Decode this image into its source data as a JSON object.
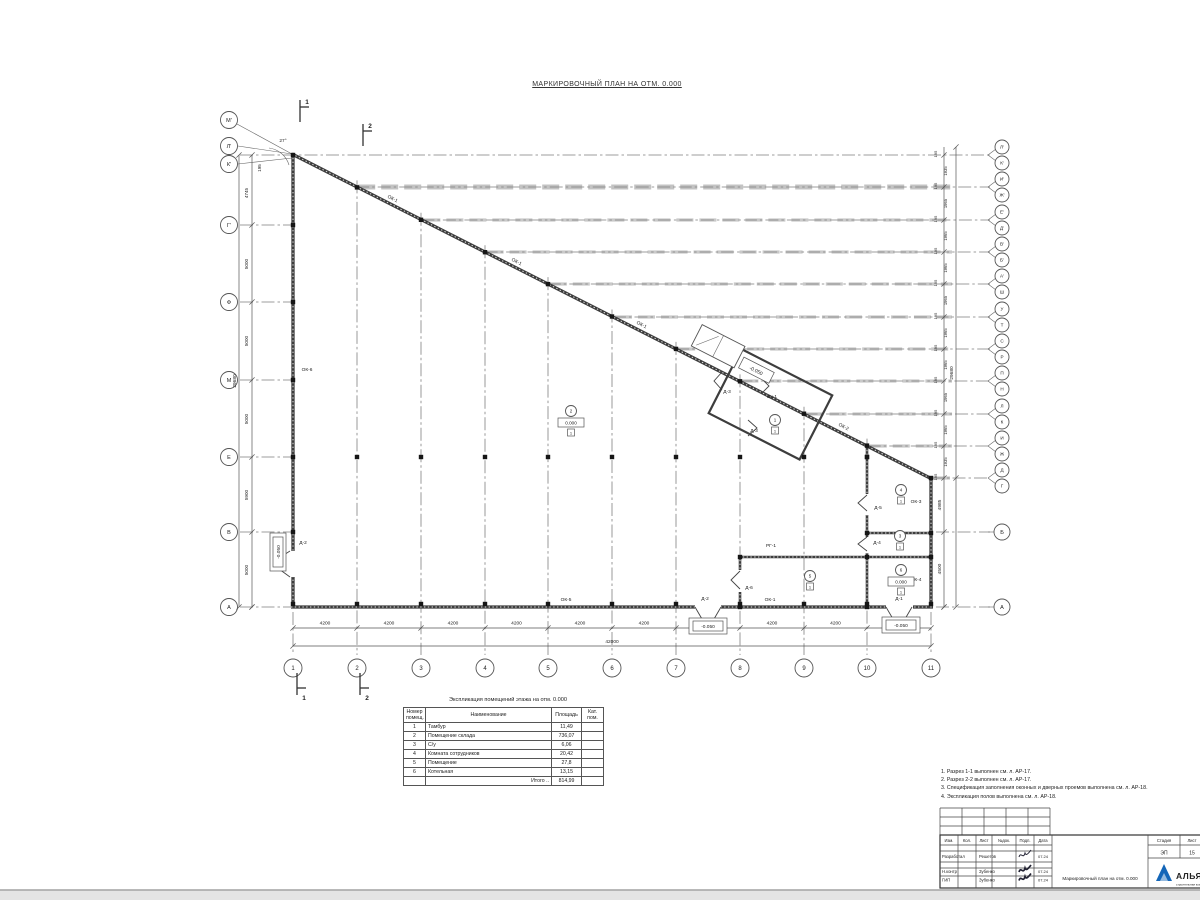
{
  "title": "МАРКИРОВОЧНЫЙ ПЛАН НА ОТМ. 0.000",
  "colors": {
    "accent_blue": "#1466b8",
    "band_gray": "#c9c9c9"
  },
  "plan": {
    "diag": {
      "x1": 293,
      "y1": 155,
      "x2": 931,
      "y2": 478,
      "slope": 0.5063
    },
    "walls": {
      "ext": [
        [
          293,
          154,
          293,
          608
        ],
        [
          291,
          607,
          933,
          607
        ],
        [
          931,
          477,
          931,
          608
        ],
        [
          292,
          154,
          932,
          479
        ]
      ],
      "int": [
        [
          867,
          446,
          867,
          607
        ],
        [
          740,
          556,
          740,
          607
        ],
        [
          739,
          557,
          932,
          557
        ],
        [
          866,
          533,
          932,
          533
        ]
      ],
      "gaps": [
        [
          695,
          602,
          26,
          9
        ],
        [
          886,
          602,
          27,
          9
        ],
        [
          288,
          551,
          9,
          26
        ],
        [
          863,
          494,
          8,
          21
        ],
        [
          863,
          537,
          8,
          16
        ],
        [
          736,
          570,
          8,
          22
        ]
      ],
      "doors": [
        "M695,607 L702,619 L714,619 L721,607",
        "M886,607 L893,619 L905,619 L912,607",
        "M290,551 L279,558 L279,569 L290,577",
        "M867,495 l-9,8 l9,8",
        "M867,537 l-9,7 l9,7",
        "M740,571 l-9,9 l9,9",
        "M722,372 l-8,9 l8,9",
        "M748,420 l9,8 l-9,8",
        "M762,379 l7,7 l-7,7"
      ]
    },
    "tambour": {
      "cx": 766,
      "cy": 402,
      "rot": 27,
      "main": [
        -46,
        -36,
        102,
        72
      ],
      "porch": [
        -92,
        -40,
        48,
        24
      ],
      "ebox": [
        -40,
        -30,
        34,
        12
      ],
      "etext": "-0.050"
    },
    "bottom_axes": [
      {
        "n": "1",
        "x": 293
      },
      {
        "n": "2",
        "x": 357
      },
      {
        "n": "3",
        "x": 421
      },
      {
        "n": "4",
        "x": 485
      },
      {
        "n": "5",
        "x": 548
      },
      {
        "n": "6",
        "x": 612
      },
      {
        "n": "7",
        "x": 676
      },
      {
        "n": "8",
        "x": 740
      },
      {
        "n": "9",
        "x": 804
      },
      {
        "n": "10",
        "x": 867
      },
      {
        "n": "11",
        "x": 931
      }
    ],
    "bottom_seg_dim": "4200",
    "bottom_total": "42000",
    "left_axes": [
      {
        "n": "М'",
        "cy": 120
      },
      {
        "n": "Л'",
        "cy": 146
      },
      {
        "n": "К'",
        "cy": 164
      },
      {
        "n": "Г'",
        "cy": 225,
        "row": 225
      },
      {
        "n": "Ф",
        "cy": 302,
        "row": 302
      },
      {
        "n": "М",
        "cy": 380,
        "row": 380
      },
      {
        "n": "Е",
        "cy": 457,
        "row": 457
      },
      {
        "n": "В",
        "cy": 532,
        "row": 532
      },
      {
        "n": "А",
        "cy": 607,
        "row": 607
      }
    ],
    "left_dim_labels": [
      {
        "t": "195",
        "y": 168,
        "x": 261
      },
      {
        "t": "4745",
        "y": 193
      },
      {
        "t": "5000",
        "y": 264
      },
      {
        "t": "5000",
        "y": 341
      },
      {
        "t": "5000",
        "y": 419
      },
      {
        "t": "5900",
        "y": 495
      },
      {
        "t": "5000",
        "y": 570
      }
    ],
    "left_total": "29680",
    "pair_rows": [
      {
        "y": 155,
        "a": "Л'",
        "b": "К'"
      },
      {
        "y": 187,
        "a": "И'",
        "b": "Ж'"
      },
      {
        "y": 220,
        "a": "Е'",
        "b": "Д'"
      },
      {
        "y": 252,
        "a": "В'",
        "b": "Б'"
      },
      {
        "y": 284,
        "a": "А'",
        "b": "Ш"
      },
      {
        "y": 317,
        "a": "У",
        "b": "Т"
      },
      {
        "y": 349,
        "a": "С",
        "b": "Р"
      },
      {
        "y": 381,
        "a": "П",
        "b": "Н"
      },
      {
        "y": 414,
        "a": "Л",
        "b": "К"
      },
      {
        "y": 446,
        "a": "И",
        "b": "Ж"
      },
      {
        "y": 478,
        "a": "Д",
        "b": "Г"
      }
    ],
    "right_pair_dim": "195",
    "right_gap_dims": [
      "1935",
      "1965",
      "1965",
      "1965",
      "1965",
      "1965",
      "1965",
      "1965",
      "1965",
      "1935"
    ],
    "right_total": "29680",
    "right_low_axes": [
      {
        "n": "Б",
        "y": 532
      },
      {
        "n": "А",
        "y": 607
      }
    ],
    "right_low_dims": [
      {
        "t": "4985",
        "y": 505
      },
      {
        "t": "4500",
        "y": 569
      }
    ],
    "mark_labels": [
      {
        "t": "ОК-1",
        "x": 392,
        "y": 200,
        "r": 27
      },
      {
        "t": "ОК-1",
        "x": 516,
        "y": 263,
        "r": 27
      },
      {
        "t": "ОК-1",
        "x": 641,
        "y": 326,
        "r": 27
      },
      {
        "t": "ОК-2",
        "x": 843,
        "y": 428,
        "r": 27
      },
      {
        "t": "ОК-3",
        "x": 916,
        "y": 503
      },
      {
        "t": "ОК-4",
        "x": 916,
        "y": 581
      },
      {
        "t": "ОК-5",
        "x": 566,
        "y": 601
      },
      {
        "t": "ОК-1",
        "x": 770,
        "y": 601
      },
      {
        "t": "ОК-6",
        "x": 307,
        "y": 371
      },
      {
        "t": "РГ-1",
        "x": 771,
        "y": 547
      },
      {
        "t": "Д-2",
        "x": 303,
        "y": 544
      },
      {
        "t": "Д-2",
        "x": 705,
        "y": 600
      },
      {
        "t": "Д-1",
        "x": 899,
        "y": 600
      },
      {
        "t": "Д-6",
        "x": 749,
        "y": 589
      },
      {
        "t": "Д-5",
        "x": 878,
        "y": 509
      },
      {
        "t": "Д-4",
        "x": 877,
        "y": 544
      },
      {
        "t": "Д-3",
        "x": 727,
        "y": 393
      },
      {
        "t": "Д-3",
        "x": 754,
        "y": 432
      },
      {
        "t": "Вн-1",
        "x": 772,
        "y": 398
      }
    ],
    "rooms": [
      {
        "n": "1",
        "x": 775,
        "y": 420,
        "f": "1"
      },
      {
        "n": "2",
        "x": 571,
        "y": 411,
        "e": "0.000",
        "f": "1"
      },
      {
        "n": "3",
        "x": 900,
        "y": 536,
        "f": "1"
      },
      {
        "n": "4",
        "x": 901,
        "y": 490,
        "f": "1"
      },
      {
        "n": "5",
        "x": 810,
        "y": 576,
        "f": "1"
      },
      {
        "n": "6",
        "x": 901,
        "y": 570,
        "e": "0.000",
        "f": "1"
      }
    ],
    "elevations": [
      {
        "t": "-0.050",
        "x": 278,
        "y": 552,
        "r": -90
      },
      {
        "t": "-0.050",
        "x": 708,
        "y": 626,
        "r": 0
      },
      {
        "t": "-0.050",
        "x": 901,
        "y": 625,
        "r": 0
      }
    ],
    "sections": [
      {
        "n": "1",
        "x": 300,
        "y": 100,
        "d": 1
      },
      {
        "n": "2",
        "x": 363,
        "y": 124,
        "d": 1
      },
      {
        "n": "1",
        "x": 297,
        "y": 673,
        "d": -1
      },
      {
        "n": "2",
        "x": 360,
        "y": 673,
        "d": -1
      }
    ],
    "angle": {
      "t": "27°",
      "x": 283,
      "y": 142
    },
    "extra_squares": [
      [
        931,
        533
      ],
      [
        931,
        557
      ],
      [
        867,
        457
      ],
      [
        867,
        533
      ],
      [
        867,
        557
      ],
      [
        867,
        607
      ],
      [
        740,
        557
      ],
      [
        740,
        607
      ],
      [
        293,
        155
      ],
      [
        931,
        478
      ]
    ],
    "leftwall_square_rows": [
      225,
      302,
      380,
      532
    ]
  },
  "table": {
    "title": "Экспликация помещений этажа на отм. 0.000",
    "headers": [
      "Номер помещ.",
      "Наименование",
      "Площадь",
      "Кат. пом."
    ],
    "rows": [
      [
        "1",
        "Тамбур",
        "11,49",
        ""
      ],
      [
        "2",
        "Помещение склада",
        "736,07",
        ""
      ],
      [
        "3",
        "С/у",
        "6,06",
        ""
      ],
      [
        "4",
        "Комната сотрудников",
        "20,42",
        ""
      ],
      [
        "5",
        "Помещение",
        "27,8",
        ""
      ],
      [
        "6",
        "Котельная",
        "13,15",
        ""
      ]
    ],
    "total_label": "Итого ..",
    "total_value": "814,99"
  },
  "notes": [
    "1. Разрез 1-1 выполнен см. л. АР-17.",
    "2. Разрез 2-2 выполнен см. л. АР-17.",
    "3. Спецификация заполнения оконных и дверных проемов выполнена см. л. АР-18.",
    "4. Экспликация полов выполнена см. л. АР-18."
  ],
  "stamp": {
    "header_cols": [
      "Изм.",
      "Кол.",
      "Лист",
      "№док.",
      "Подп.",
      "Дата"
    ],
    "rows": [
      {
        "role": "Разработал",
        "name": "Решетов",
        "date": "07.24",
        "sig": true
      },
      {
        "role": "Н.контр",
        "name": "Зубенко",
        "date": "07.24",
        "sig": true
      },
      {
        "role": "ГИП",
        "name": "Зубенко",
        "date": "07.24",
        "sig": true
      }
    ],
    "doc_name": "Маркировочный план на отм. 0.000",
    "stage_label": "Стадия",
    "sheet_label": "Лист",
    "stage": "ЭП",
    "sheet": "15",
    "logo_text": "АЛЬЯНС",
    "logo_sub": "строительная компания"
  }
}
